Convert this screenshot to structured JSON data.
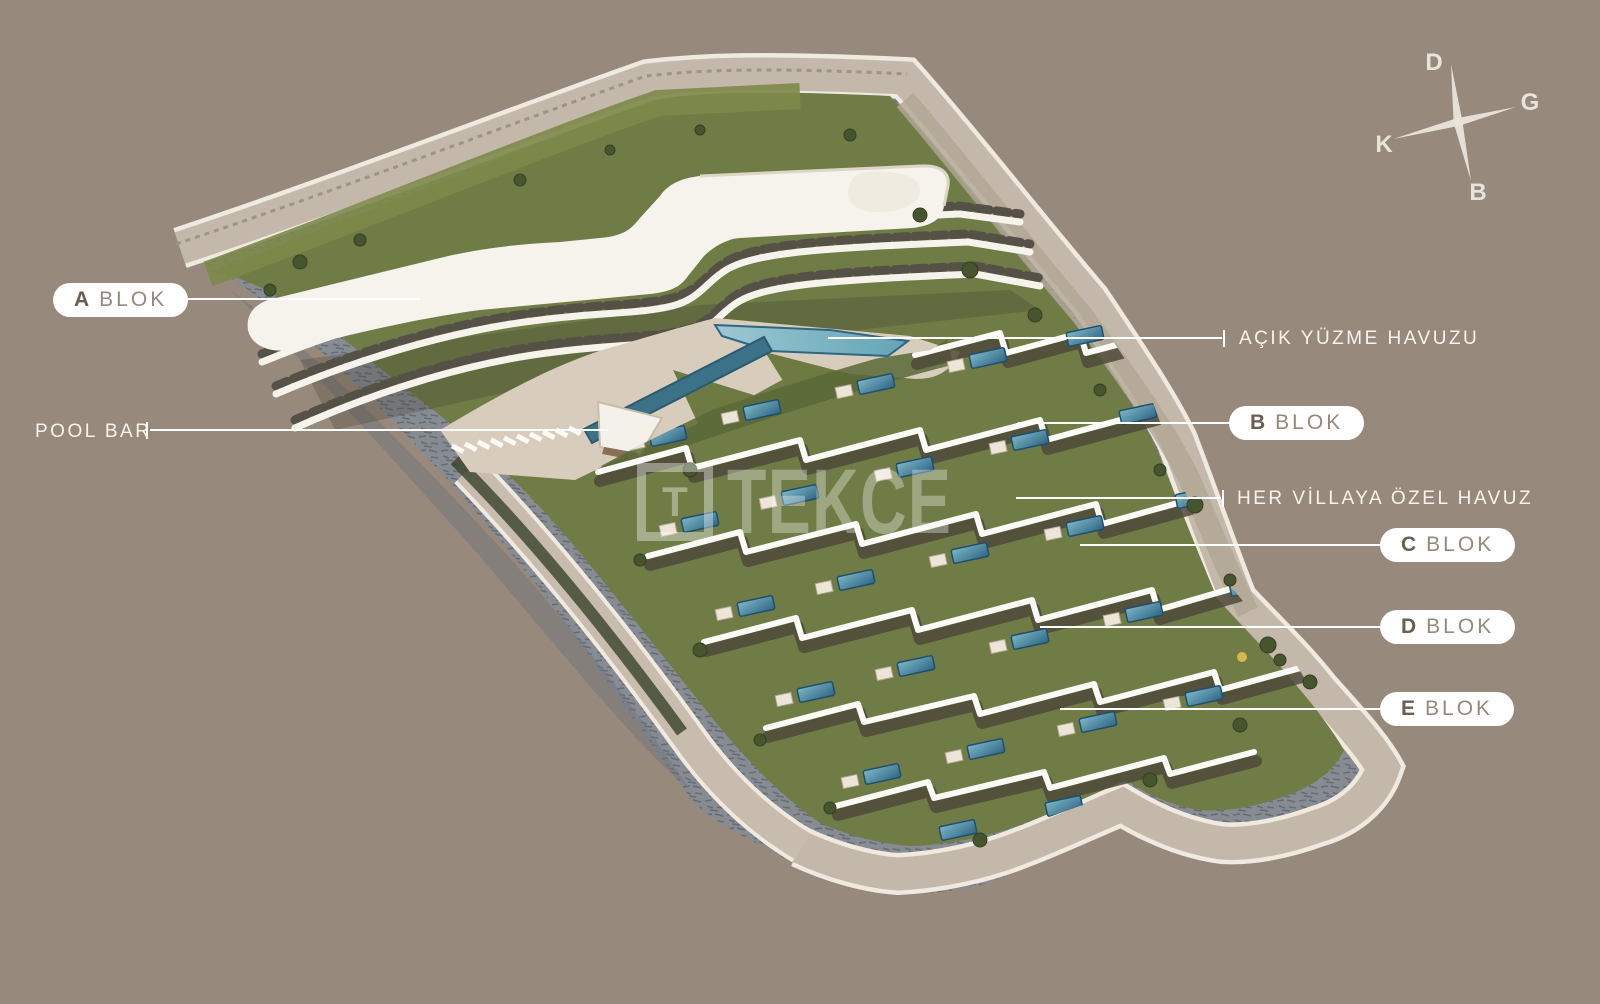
{
  "scene_title": "site-plan-render",
  "colors": {
    "background": "#97897b",
    "label_box": "#ffffff",
    "label_letter": "#6a5e50",
    "label_word": "#948a7c",
    "annotation_text": "#f7f4ee",
    "leader_line": "#ffffff",
    "compass": "#e9e4da",
    "building_white": "#f6f3ec",
    "grass_green": "#6f7c45",
    "pool_blue": "#4d8fa8",
    "road_tan": "#c3b8a9",
    "stone_gray": "#878b92"
  },
  "labels": {
    "a": {
      "letter": "A",
      "word": "BLOK"
    },
    "b": {
      "letter": "B",
      "word": "BLOK"
    },
    "c": {
      "letter": "C",
      "word": "BLOK"
    },
    "d": {
      "letter": "D",
      "word": "BLOK"
    },
    "e": {
      "letter": "E",
      "word": "BLOK"
    },
    "pool_bar": {
      "text": "POOL BAR"
    },
    "open_pool": {
      "text": "AÇIK YÜZME HAVUZU"
    },
    "villa_pool": {
      "text": "HER VİLLAYA ÖZEL HAVUZ"
    }
  },
  "compass": {
    "top": "D",
    "right": "G",
    "left": "K",
    "bottom": "B"
  },
  "watermark": {
    "logo": "T",
    "name": "TEKCE"
  }
}
